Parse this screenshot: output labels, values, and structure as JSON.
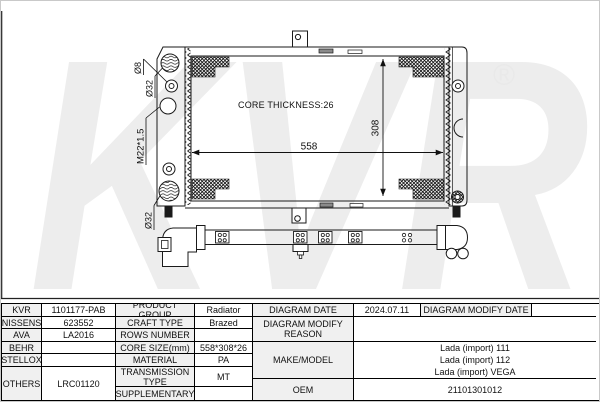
{
  "colors": {
    "line": "#1a1a1a",
    "watermark": "#ededed",
    "registered_gray": "#e9e9e9",
    "cell_label_bg": "#f0f0f0",
    "slot_fill": "#8a8a8a"
  },
  "watermark": {
    "text": "KVR",
    "registered": "®"
  },
  "diagram": {
    "core_thickness": "CORE THICKNESS:26",
    "width_dim": "558",
    "height_dim": "308",
    "inlet_diameter": "Ø8",
    "top_port_diameter": "Ø32",
    "thread_spec": "M22*1.5",
    "bottom_port_diameter": "Ø32",
    "outlet_diameter": "Ø32"
  },
  "table": {
    "kvr": {
      "label": "KVR",
      "value": "1101177-PAB"
    },
    "nissens": {
      "label": "NISSENS",
      "value": "623552"
    },
    "ava": {
      "label": "AVA",
      "value": "LA2016"
    },
    "behr": {
      "label": "BEHR",
      "value": ""
    },
    "stellox": {
      "label": "STELLOX",
      "value": ""
    },
    "others": {
      "label": "OTHERS",
      "value": "LRC01120"
    },
    "product_group": {
      "label": "PRODUCT GROUP",
      "value": "Radiator"
    },
    "craft_type": {
      "label": "CRAFT TYPE",
      "value": "Brazed"
    },
    "rows_number": {
      "label": "ROWS NUMBER",
      "value": ""
    },
    "core_size": {
      "label": "CORE SIZE(mm)",
      "value": "558*308*26"
    },
    "material": {
      "label": "MATERIAL",
      "value": "PA"
    },
    "transmission": {
      "label": "TRANSMISSION TYPE",
      "value": "MT"
    },
    "supplementary": {
      "label": "SUPPLEMENTARY",
      "value": ""
    },
    "diagram_date": {
      "label": "DIAGRAM DATE",
      "value": "2024.07.11"
    },
    "diagram_modify_date": {
      "label": "DIAGRAM MODIFY DATE",
      "value": ""
    },
    "diagram_modify_reason": {
      "label": "DIAGRAM MODIFY REASON",
      "value": ""
    },
    "make_model": {
      "label": "MAKE/MODEL",
      "values": [
        "Lada (import) 111",
        "Lada (import) 112",
        "Lada (import) VEGA"
      ]
    },
    "oem": {
      "label": "OEM",
      "value": "21101301012"
    }
  }
}
